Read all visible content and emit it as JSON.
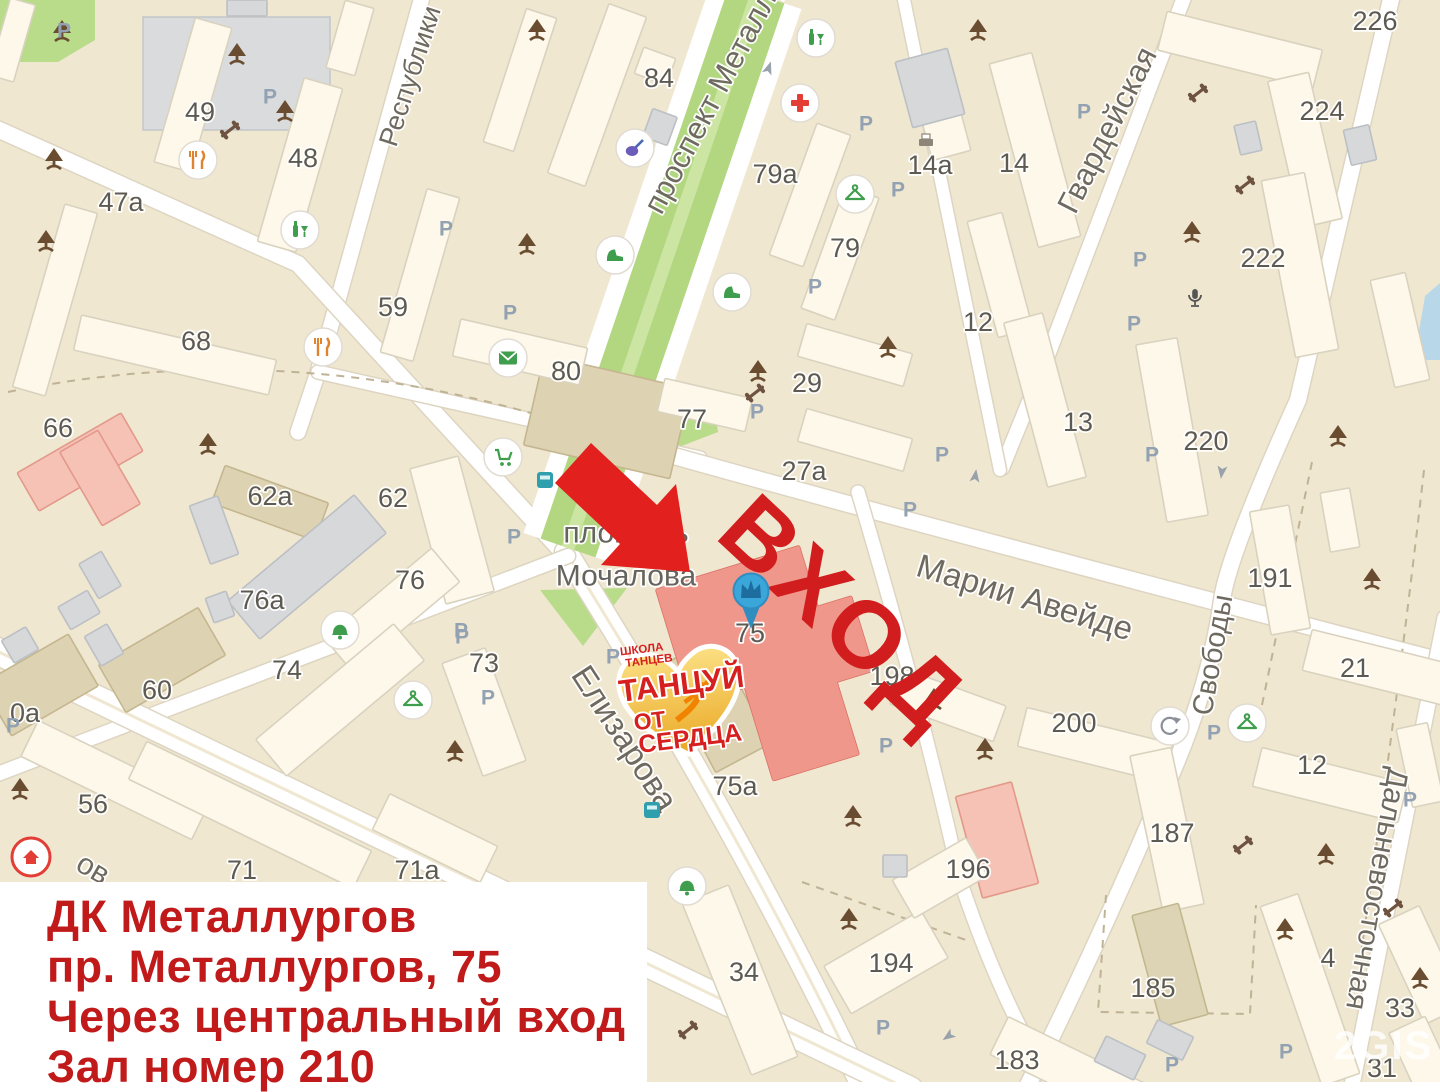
{
  "colors": {
    "background": "#f0e7d1",
    "road": "#ffffff",
    "road_casing": "#ddd5c1",
    "accent_red": "#cd1a1a",
    "arrow_red": "#e2211e",
    "pin_blue": "#3aa6da",
    "logo_gold": "#f5c63f",
    "green_park": "#b8dc8a",
    "green_boulevard": "#b2d780"
  },
  "map": {
    "background": "#f0e7d1",
    "palette": [
      {
        "f": "#fdf8ea",
        "s": "#d9d2bf"
      },
      {
        "f": "#ddd2b2",
        "s": "#c4b790"
      },
      {
        "f": "#d6d8da",
        "s": "#bcc0c4"
      },
      {
        "f": "#f6c2b6",
        "s": "#e2998a"
      },
      {
        "f": "#f0978c",
        "s": "#da7164"
      },
      {
        "f": "#dcd4b4",
        "s": "#c2b890"
      }
    ],
    "streets": [
      [
        "Республики",
        410,
        76,
        -72,
        27
      ],
      [
        "проспект Металлургов",
        728,
        68,
        -62,
        31
      ],
      [
        "Гвардейская",
        1107,
        130,
        -63,
        31
      ],
      [
        "Марии Авейде",
        1025,
        597,
        17,
        33
      ],
      [
        "Свободы",
        1213,
        655,
        -80,
        29
      ],
      [
        "Елизарова",
        625,
        738,
        57,
        33
      ],
      [
        "Дальневосточная",
        1398,
        768,
        100,
        30,
        "start"
      ],
      [
        "ов",
        93,
        869,
        30,
        30
      ]
    ],
    "area_label": {
      "line1": "площадь",
      "line2": "Мочалова",
      "x": 626,
      "y1": 533,
      "y2": 576
    },
    "numbers": [
      [
        "49",
        200,
        112
      ],
      [
        "48",
        303,
        158
      ],
      [
        "47а",
        121,
        202
      ],
      [
        "68",
        196,
        341
      ],
      [
        "66",
        58,
        428
      ],
      [
        "62а",
        270,
        496
      ],
      [
        "62",
        393,
        498
      ],
      [
        "59",
        393,
        307
      ],
      [
        "76а",
        262,
        600
      ],
      [
        "76",
        410,
        580
      ],
      [
        "74",
        287,
        670
      ],
      [
        "73",
        484,
        663
      ],
      [
        "60",
        157,
        690
      ],
      [
        "0а",
        10,
        713
      ],
      [
        "56",
        93,
        804
      ],
      [
        "71",
        242,
        870
      ],
      [
        "71а",
        417,
        870
      ],
      [
        "84",
        659,
        78
      ],
      [
        "80",
        566,
        371
      ],
      [
        "77",
        692,
        419
      ],
      [
        "79а",
        775,
        174
      ],
      [
        "79",
        845,
        248
      ],
      [
        "29",
        807,
        383
      ],
      [
        "27а",
        804,
        471
      ],
      [
        "14а",
        930,
        165
      ],
      [
        "14",
        1014,
        163
      ],
      [
        "12",
        978,
        322
      ],
      [
        "13",
        1078,
        422
      ],
      [
        "220",
        1206,
        441
      ],
      [
        "222",
        1263,
        258
      ],
      [
        "224",
        1322,
        111
      ],
      [
        "226",
        1375,
        21
      ],
      [
        "191",
        1270,
        578
      ],
      [
        "21",
        1355,
        668
      ],
      [
        "198",
        892,
        676
      ],
      [
        "200",
        1074,
        723
      ],
      [
        "196",
        968,
        869
      ],
      [
        "187",
        1172,
        833
      ],
      [
        "185",
        1153,
        988
      ],
      [
        "183",
        1017,
        1060
      ],
      [
        "194",
        891,
        963
      ],
      [
        "34",
        744,
        972
      ],
      [
        "75а",
        735,
        786
      ],
      [
        "75",
        750,
        633
      ],
      [
        "12",
        1312,
        765
      ],
      [
        "4",
        1328,
        958
      ],
      [
        "33",
        1400,
        1008
      ],
      [
        "31",
        1382,
        1068
      ]
    ],
    "buildings": [
      [
        193,
        95,
        38,
        150,
        16,
        0
      ],
      [
        300,
        165,
        40,
        170,
        16,
        0
      ],
      [
        55,
        300,
        34,
        190,
        16,
        0
      ],
      [
        350,
        38,
        30,
        70,
        16,
        0
      ],
      [
        420,
        275,
        34,
        170,
        16,
        0
      ],
      [
        175,
        355,
        200,
        36,
        13,
        0
      ],
      [
        12,
        40,
        26,
        80,
        16,
        0
      ],
      [
        247,
        8,
        40,
        16,
        0,
        2
      ],
      [
        520,
        80,
        32,
        140,
        18,
        0
      ],
      [
        655,
        66,
        34,
        28,
        20,
        0
      ],
      [
        660,
        127,
        26,
        30,
        20,
        2
      ],
      [
        80,
        462,
        120,
        44,
        -30,
        3
      ],
      [
        100,
        478,
        44,
        85,
        -30,
        3
      ],
      [
        270,
        503,
        110,
        40,
        20,
        1
      ],
      [
        452,
        530,
        50,
        140,
        -15,
        0
      ],
      [
        607,
        417,
        150,
        92,
        13,
        1
      ],
      [
        307,
        567,
        165,
        50,
        -40,
        2
      ],
      [
        392,
        610,
        140,
        44,
        -40,
        0
      ],
      [
        340,
        700,
        180,
        48,
        -40,
        0
      ],
      [
        484,
        712,
        46,
        120,
        -20,
        0
      ],
      [
        162,
        660,
        115,
        55,
        -30,
        1
      ],
      [
        40,
        685,
        100,
        60,
        -30,
        1
      ],
      [
        100,
        575,
        26,
        40,
        -30,
        2
      ],
      [
        79,
        610,
        34,
        26,
        -30,
        2
      ],
      [
        104,
        645,
        26,
        34,
        -30,
        2
      ],
      [
        214,
        530,
        30,
        62,
        -20,
        2
      ],
      [
        220,
        607,
        22,
        26,
        -20,
        2
      ],
      [
        20,
        645,
        28,
        26,
        -30,
        2
      ],
      [
        115,
        780,
        190,
        40,
        26,
        0
      ],
      [
        250,
        815,
        250,
        42,
        26,
        0
      ],
      [
        435,
        838,
        120,
        40,
        26,
        0
      ],
      [
        597,
        95,
        40,
        180,
        20,
        0
      ],
      [
        520,
        352,
        130,
        38,
        13,
        0
      ],
      [
        705,
        405,
        90,
        34,
        13,
        0
      ],
      [
        810,
        195,
        36,
        140,
        20,
        0
      ],
      [
        840,
        253,
        36,
        130,
        20,
        0
      ],
      [
        855,
        355,
        110,
        34,
        16,
        0
      ],
      [
        855,
        440,
        110,
        34,
        16,
        0
      ],
      [
        940,
        112,
        40,
        90,
        -15,
        0
      ],
      [
        930,
        88,
        54,
        68,
        -15,
        2
      ],
      [
        1035,
        150,
        44,
        190,
        -15,
        0
      ],
      [
        1000,
        275,
        36,
        120,
        -15,
        0
      ],
      [
        1045,
        400,
        40,
        170,
        -15,
        0
      ],
      [
        1240,
        50,
        160,
        40,
        14,
        0
      ],
      [
        1305,
        150,
        42,
        150,
        -13,
        0
      ],
      [
        1360,
        145,
        26,
        36,
        -13,
        2
      ],
      [
        1248,
        138,
        22,
        30,
        -13,
        2
      ],
      [
        1300,
        265,
        44,
        180,
        -11,
        0
      ],
      [
        1400,
        330,
        36,
        110,
        -13,
        0
      ],
      [
        1172,
        430,
        42,
        180,
        -10,
        0
      ],
      [
        1280,
        570,
        40,
        125,
        -10,
        0
      ],
      [
        1340,
        520,
        30,
        60,
        -10,
        0
      ],
      [
        1380,
        668,
        150,
        42,
        14,
        0
      ],
      [
        1095,
        745,
        150,
        40,
        14,
        0
      ],
      [
        948,
        705,
        110,
        38,
        20,
        0
      ],
      [
        997,
        840,
        58,
        105,
        -15,
        3
      ],
      [
        1167,
        830,
        42,
        160,
        -12,
        0
      ],
      [
        1170,
        965,
        48,
        115,
        -15,
        5
      ],
      [
        1080,
        1075,
        180,
        42,
        26,
        0
      ],
      [
        1120,
        1058,
        44,
        28,
        26,
        2
      ],
      [
        1170,
        1040,
        40,
        26,
        26,
        2
      ],
      [
        886,
        962,
        112,
        55,
        -30,
        0
      ],
      [
        940,
        878,
        85,
        44,
        -30,
        0
      ],
      [
        895,
        866,
        24,
        22,
        0,
        2
      ],
      [
        740,
        980,
        50,
        185,
        -22,
        0
      ],
      [
        715,
        705,
        62,
        120,
        -28,
        1
      ],
      [
        1330,
        785,
        150,
        40,
        14,
        0
      ],
      [
        1310,
        990,
        40,
        190,
        -19,
        0
      ],
      [
        1422,
        965,
        45,
        110,
        -25,
        0
      ],
      [
        1428,
        1070,
        40,
        100,
        -25,
        0
      ],
      [
        1420,
        765,
        32,
        80,
        -12,
        0
      ]
    ],
    "target_building": {
      "number": "75",
      "rects": [
        [
          745,
          625,
          150,
          120,
          -17
        ],
        [
          815,
          648,
          100,
          78,
          -17
        ],
        [
          800,
          715,
          90,
          110,
          -17
        ]
      ]
    },
    "roads": [
      [
        "M 424,-10 L 318,372 L 298,432",
        15,
        0
      ],
      [
        "M -5,128 L 298,264 L 566,556",
        16,
        0
      ],
      [
        "M 318,372 L 700,458",
        13,
        0
      ],
      [
        "M 660,452 Q 900,520 1445,662",
        16,
        0
      ],
      [
        "M 1185,-5 L 1048,355 L 1002,468",
        14,
        0
      ],
      [
        "M 903,-5 L 1000,470",
        12,
        0
      ],
      [
        "M 1392,-5 L 1298,400 Q 1228,555 1222,600 Q 1208,700 1155,810 Q 1095,950 1028,1085",
        16,
        0
      ],
      [
        "M 566,552 Q 740,830 862,1085",
        22,
        1
      ],
      [
        "M 568,556 L -5,775",
        14,
        0
      ],
      [
        "M -5,650 L 910,1090",
        26,
        1
      ],
      [
        "M 1445,618 L 1352,1085",
        15,
        0
      ],
      [
        "M 858,492 Q 920,700 960,880 Q 1000,1000 1052,1085",
        13,
        0
      ]
    ],
    "boulevard": {
      "d": "M 757,-6 L 568,548",
      "outer": 94,
      "inner": 58,
      "center": 13,
      "inner_color": "#b2d780",
      "center_color": "#cde5a3"
    },
    "greens": {
      "polys": [
        "0,0 95,0 95,40 58,62 0,62",
        "597,442 712,392 718,432 640,462",
        "540,590 627,588 583,646"
      ],
      "ellipse": [
        570,
        503,
        22,
        27
      ],
      "fill": "#b8dc8a",
      "ellipse_fill": "#cbe5a1"
    },
    "water": "1425,296 1440,283 1440,360 1414,360",
    "parking_lot": [
      143,
      17,
      187,
      113
    ],
    "dashes": [
      "M 8,392 Q 300,332 598,434",
      "M 1106,895 L 1098,1012 L 1250,1014 L 1256,905",
      "M 1312,462 L 1262,705",
      "M 1424,470 Q 1398,700 1360,960",
      "M 802,882 L 966,940"
    ],
    "trees": [
      [
        237,
        55
      ],
      [
        285,
        112
      ],
      [
        54,
        160
      ],
      [
        46,
        242
      ],
      [
        208,
        445
      ],
      [
        537,
        31
      ],
      [
        527,
        245
      ],
      [
        888,
        348
      ],
      [
        758,
        372
      ],
      [
        934,
        700
      ],
      [
        978,
        31
      ],
      [
        1192,
        233
      ],
      [
        1338,
        437
      ],
      [
        1372,
        580
      ],
      [
        20,
        790
      ],
      [
        455,
        752
      ],
      [
        853,
        817
      ],
      [
        849,
        920
      ],
      [
        1326,
        855
      ],
      [
        1285,
        930
      ],
      [
        1420,
        979
      ],
      [
        985,
        750
      ],
      [
        62,
        32
      ]
    ],
    "dumbbells": [
      [
        230,
        130
      ],
      [
        1198,
        93
      ],
      [
        755,
        393
      ],
      [
        1245,
        185
      ],
      [
        1243,
        845
      ],
      [
        688,
        1030
      ],
      [
        1393,
        908
      ]
    ],
    "parking_marks": [
      [
        270,
        97
      ],
      [
        64,
        31
      ],
      [
        446,
        229
      ],
      [
        510,
        313
      ],
      [
        866,
        124
      ],
      [
        815,
        287
      ],
      [
        898,
        190
      ],
      [
        1084,
        112
      ],
      [
        1140,
        260
      ],
      [
        1134,
        324
      ],
      [
        1152,
        455
      ],
      [
        910,
        510
      ],
      [
        942,
        455
      ],
      [
        757,
        412
      ],
      [
        886,
        746
      ],
      [
        883,
        1028
      ],
      [
        1214,
        733
      ],
      [
        1410,
        800
      ],
      [
        1286,
        1052
      ],
      [
        1172,
        1065
      ],
      [
        13,
        726
      ],
      [
        462,
        637
      ],
      [
        613,
        657
      ],
      [
        514,
        537
      ],
      [
        461,
        631
      ],
      [
        488,
        698
      ]
    ],
    "parking_letter": "P",
    "pois": [
      [
        "restaurant",
        198,
        160
      ],
      [
        "restaurant",
        323,
        347
      ],
      [
        "bottle",
        300,
        230
      ],
      [
        "bottle",
        816,
        38
      ],
      [
        "cross",
        800,
        103
      ],
      [
        "hanger",
        855,
        194
      ],
      [
        "shoe",
        615,
        255
      ],
      [
        "shoe",
        732,
        292
      ],
      [
        "guitar",
        635,
        148
      ],
      [
        "cart",
        503,
        457
      ],
      [
        "mail",
        508,
        358
      ],
      [
        "bell",
        340,
        630
      ],
      [
        "hanger",
        413,
        700
      ],
      [
        "bell",
        687,
        886
      ],
      [
        "hanger",
        1247,
        723
      ],
      [
        "barber",
        1170,
        726
      ],
      [
        "house",
        31,
        857
      ],
      [
        "bus",
        545,
        480
      ],
      [
        "bus",
        652,
        810
      ],
      [
        "mic",
        1195,
        298
      ],
      [
        "printer",
        926,
        141
      ]
    ],
    "road_arrows": [
      [
        768,
        70,
        19
      ],
      [
        1222,
        470,
        187
      ],
      [
        975,
        478,
        8
      ],
      [
        950,
        1035,
        235
      ]
    ]
  },
  "marker": {
    "x": 751,
    "y": 592,
    "building": "75"
  },
  "overlay": {
    "entrance_text": "ВХОД",
    "arrow_points": "555,483 591,443 657,505 676,484 690,572 601,565 620,544",
    "logo": {
      "school_line1": "ШКОЛА",
      "school_line2": "ТАНЦЕВ",
      "title1": "ТАНЦУЙ",
      "title2": "ОТ",
      "title3": "СЕРДЦА"
    },
    "infobox": {
      "lines": [
        "ДК Металлургов",
        "пр. Металлургов, 75",
        "Через центральный вход",
        "Зал номер 210"
      ]
    },
    "watermark": "2GIS"
  }
}
